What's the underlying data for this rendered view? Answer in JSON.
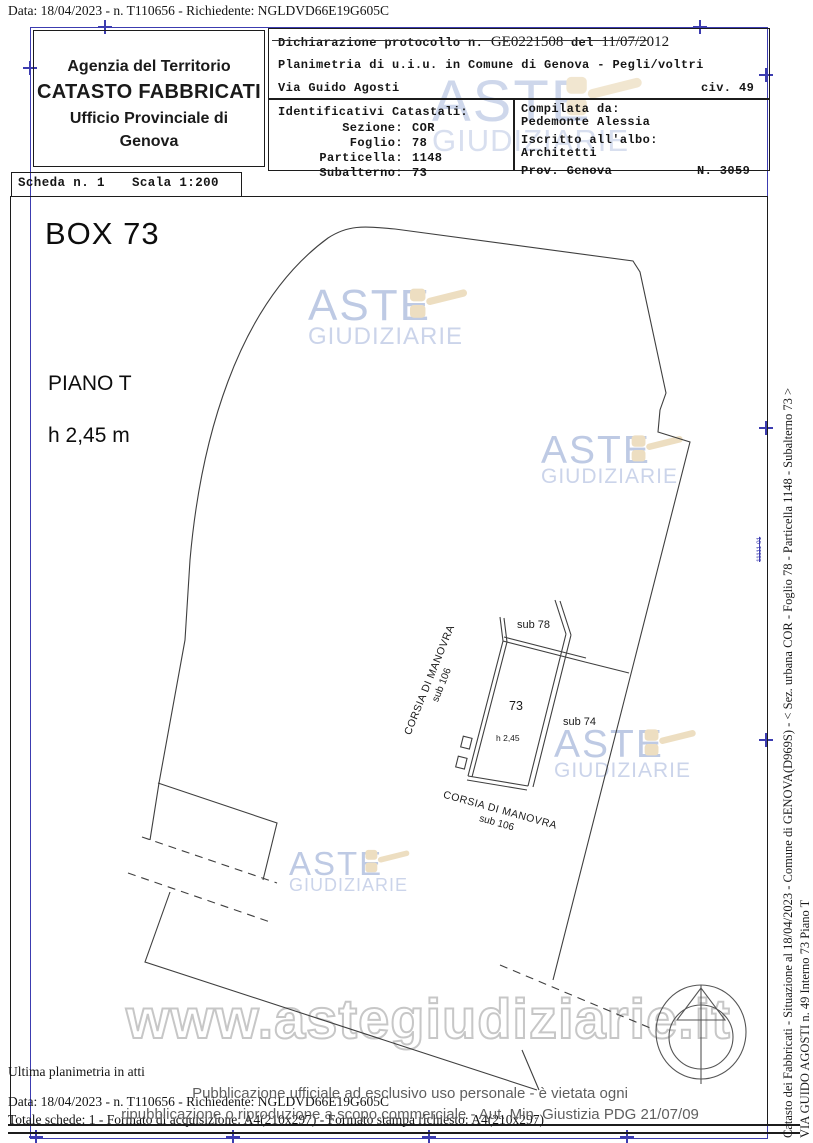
{
  "page_header": {
    "top_line": "Data: 18/04/2023 - n. T110656 - Richiedente: NGLDVD66E19G605C"
  },
  "agency_box": {
    "line1": "Agenzia del Territorio",
    "line2": "CATASTO FABBRICATI",
    "line3": "Ufficio Provinciale di",
    "line4": "Genova"
  },
  "scheda_box": {
    "scheda": "Scheda n. 1",
    "scala": "Scala 1:200"
  },
  "declaration": {
    "protocol_label": "Dichiarazione protocollo n.",
    "protocol_number": "GE0221508",
    "del_label": "del",
    "protocol_date": "11/07/2012",
    "planimetria_line": "Planimetria di u.i.u. in Comune di Genova - Pegli/voltri",
    "street": "Via Guido Agosti",
    "civic": "civ. 49"
  },
  "identifiers": {
    "title": "Identificativi Catastali:",
    "rows": [
      {
        "label": "Sezione:",
        "value": "COR"
      },
      {
        "label": "Foglio:",
        "value": "78"
      },
      {
        "label": "Particella:",
        "value": "1148"
      },
      {
        "label": "Subalterno:",
        "value": "73"
      }
    ]
  },
  "compiler": {
    "label": "Compilata da:",
    "name": "Pedemonte Alessia",
    "albo_label": "Iscritto all'albo:",
    "albo_value": "Architetti",
    "prov": "Prov. Genova",
    "number": "N. 3059"
  },
  "plan": {
    "box_title": "BOX 73",
    "floor": "PIANO T",
    "height": "h 2,45 m",
    "labels": {
      "sub78": "sub 78",
      "unit_number": "73",
      "unit_height": "h 2,45",
      "sub74": "sub 74",
      "corsia_line1": "CORSIA DI MANOVRA",
      "corsia_line2": "sub 106"
    },
    "edge_code": "11111 01"
  },
  "watermark": {
    "line1": "ASTE",
    "line2": "GIUDIZIARIE",
    "url": "www.astegiudiziarie.it",
    "aste_color": "#aebdde",
    "gavel_color": "#e9d7b2"
  },
  "sidebar": {
    "line1": "Catasto dei Fabbricati - Situazione al 18/04/2023 - Comune di GENOVA(D969S) - < Sez. urbana COR -  Foglio 78 - Particella  1148 - Subalterno 73 >",
    "line2": "VIA GUIDO AGOSTI n. 49  Interno 73 Piano T"
  },
  "footer": {
    "ultima": "Ultima planimetria in atti",
    "data_line": "Data: 18/04/2023 - n. T110656 - Richiedente: NGLDVD66E19G605C",
    "totale_line": "Totale schede: 1 - Formato di acquisizione: A4(210x297) - Formato stampa richiesto: A4(210x297)",
    "pub_line1": "Pubblicazione ufficiale ad esclusivo uso personale - è vietata ogni",
    "pub_line2": "ripubblicazione o riproduzione a scopo commerciale - Aut. Min. Giustizia PDG 21/07/09"
  }
}
